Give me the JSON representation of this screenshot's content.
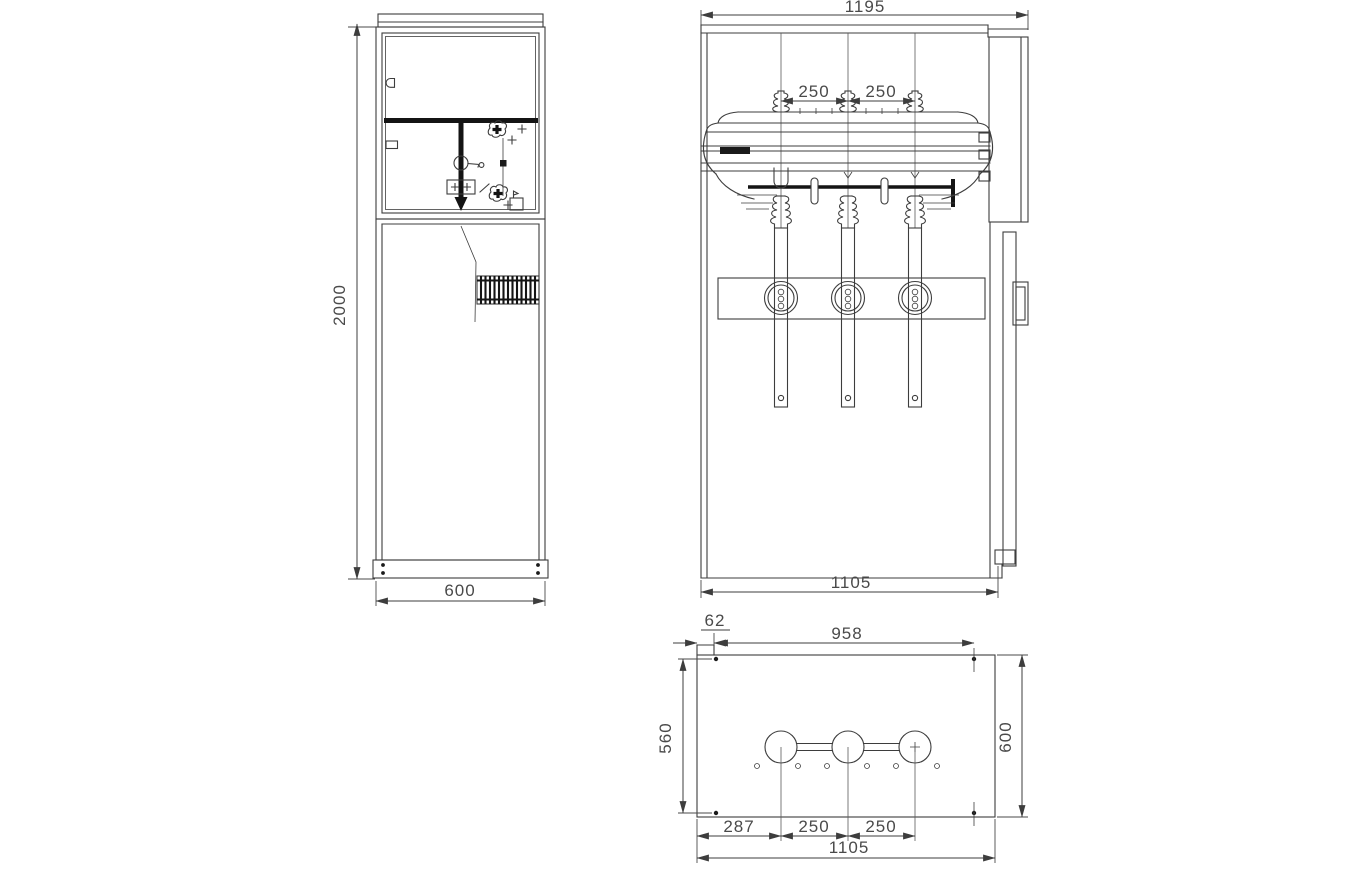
{
  "title": "Ring main unit switchgear outline and installation drawing",
  "colors": {
    "background": "#ffffff",
    "line": "#3d3d3d",
    "heavy_line": "#141414",
    "dimension_text": "#4a4a4a"
  },
  "side_view": {
    "dim_height": "2000",
    "dim_width": "600"
  },
  "front_view": {
    "dim_overall_width": "1195",
    "dim_phase_left": "250",
    "dim_phase_right": "250",
    "dim_base_width": "1105"
  },
  "plan_view": {
    "dim_edge_offset": "62",
    "dim_hole_span_x": "958",
    "dim_hole_span_y": "560",
    "dim_depth": "600",
    "dim_first_pitch": "287",
    "dim_pitch_left": "250",
    "dim_pitch_right": "250",
    "dim_overall_width": "1105"
  }
}
